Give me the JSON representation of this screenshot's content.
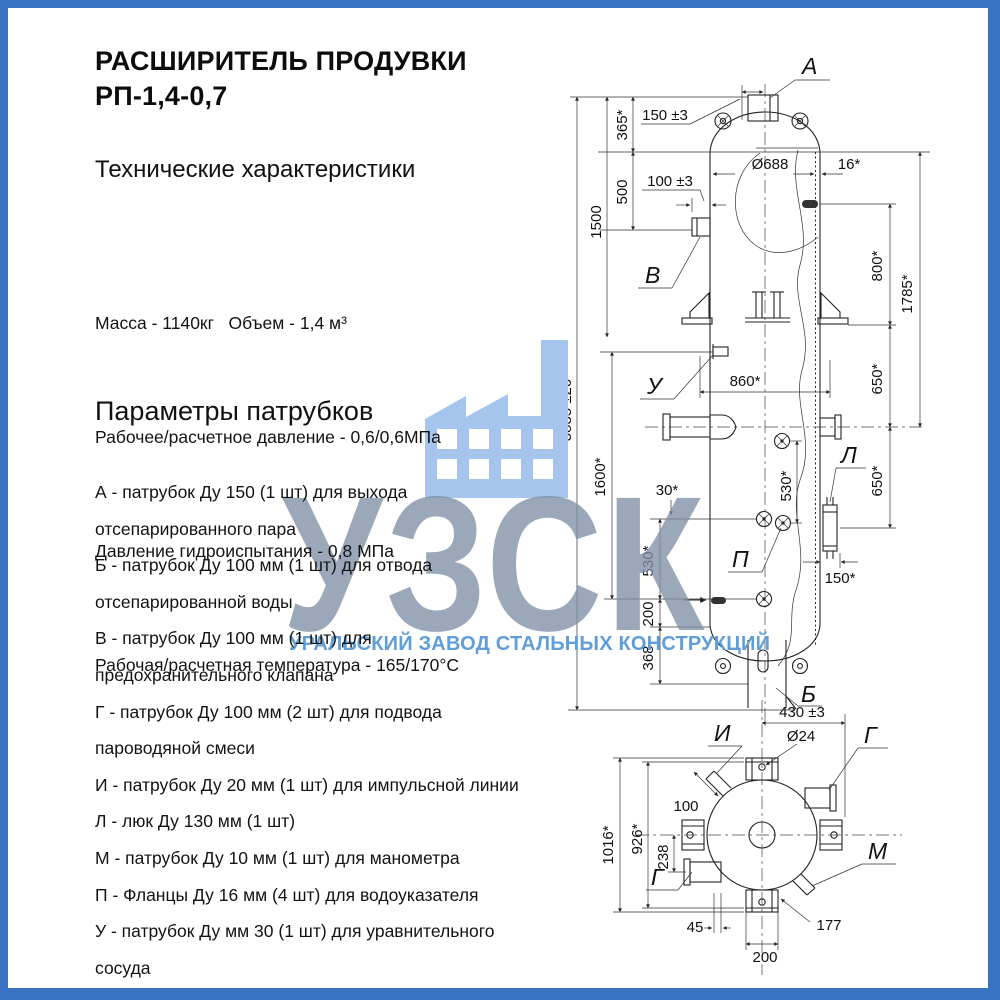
{
  "page": {
    "background": "#ffffff",
    "border_color": "#3a73c3"
  },
  "header": {
    "title_line1": "РАСШИРИТЕЛЬ ПРОДУВКИ",
    "title_line2": "РП-1,4-0,7"
  },
  "specs": {
    "heading": "Технические характеристики",
    "lines": [
      "Масса - 1140кг   Объем - 1,4 м³",
      "Рабочее/расчетное давление - 0,6/0,6МПа",
      "Давление гидроиспытания - 0,8 МПа",
      "Рабочая/расчетная температура - 165/170°С"
    ]
  },
  "nozzle_params": {
    "heading": "Параметры патрубков",
    "lines": [
      "А - патрубок Ду 150 (1 шт) для выхода",
      "отсепарированного пара",
      "Б - патрубок Ду 100 мм (1 шт) для отвода",
      "отсепарированной воды",
      "В - патрубок Ду 100 мм (1 шт) для",
      "предохранительного клапана",
      "Г - патрубок Ду 100 мм (2 шт) для подвода",
      "пароводяной смеси",
      "И - патрубок Ду 20 мм (1 шт) для импульсной линии",
      "Л - люк Ду 130 мм (1 шт)",
      "М - патрубок Ду 10 мм (1 шт) для манометра",
      "П - Фланцы Ду 16 мм (4 шт) для водоуказателя",
      "У - патрубок Ду мм 30 (1 шт) для уравнительного",
      "сосуда"
    ]
  },
  "watermark": {
    "abbr": "УЗСК",
    "caption": "УРАЛЬСКИЙ ЗАВОД СТАЛЬНЫХ КОНСТРУКЦИЙ",
    "icon": "factory-icon",
    "icon_color": "#a6c5ec",
    "abbr_color": "#7e8fa7",
    "caption_color": "#5f9ed8"
  },
  "drawing": {
    "front": {
      "labels": {
        "a": "А",
        "b": "Б",
        "v": "В",
        "u": "У",
        "l": "Л",
        "p": "П"
      },
      "dims": {
        "total": "3835 ±20",
        "d1500": "1500",
        "d365": "365*",
        "d500": "500",
        "d150a": "150 ±3",
        "d100a": "100 ±3",
        "d688": "Ø688",
        "d16": "16*",
        "d800": "800*",
        "d1785": "1785*",
        "d650a": "650*",
        "d650b": "650*",
        "d860": "860*",
        "d1600": "1600*",
        "d30": "30*",
        "d530a": "530*",
        "d530b": "530*",
        "d200": "200",
        "d368": "368",
        "d150b": "150*"
      }
    },
    "bottom": {
      "labels": {
        "i": "И",
        "g1": "Г",
        "g2": "Г",
        "m": "М"
      },
      "dims": {
        "d430": "430 ±3",
        "d24": "Ø24",
        "d100": "100",
        "d1016": "1016*",
        "d926": "926*",
        "d238": "238",
        "d45": "45",
        "d200": "200",
        "d177": "177"
      }
    }
  }
}
